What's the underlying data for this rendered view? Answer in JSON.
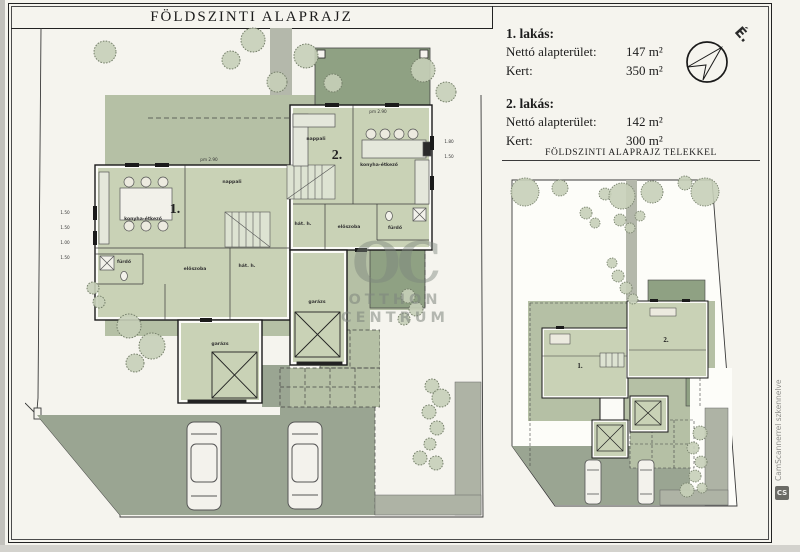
{
  "header": {
    "title": "FÖLDSZINTI ALAPRAJZ"
  },
  "info": {
    "apartments": [
      {
        "name": "1. lakás:",
        "rows": [
          {
            "label": "Nettó alapterület:",
            "value": "147 m²"
          },
          {
            "label": "Kert:",
            "value": "350 m²"
          }
        ]
      },
      {
        "name": "2. lakás:",
        "rows": [
          {
            "label": "Nettó alapterület:",
            "value": "142 m²"
          },
          {
            "label": "Kert:",
            "value": "300 m²"
          }
        ]
      }
    ]
  },
  "compass": {
    "north_label": "É."
  },
  "site_plan": {
    "heading": "FÖLDSZINTI ALAPRAJZ TELEKKEL"
  },
  "main_plan": {
    "unit1": {
      "number": "1.",
      "rooms": {
        "kitchen_dining": "konyha-étkező",
        "living": "nappali",
        "hall": "előszoba",
        "utility": "hát. h.",
        "bath": "fürdő",
        "garage": "garázs"
      }
    },
    "unit2": {
      "number": "2.",
      "rooms": {
        "kitchen_dining": "konyha-étkező",
        "living": "nappali",
        "hall": "előszoba",
        "utility": "hát. h.",
        "bath": "fürdő",
        "garage": "garázs"
      }
    },
    "dimensions": {
      "left": [
        "1.50",
        "1.50",
        "1.00",
        "1.50"
      ],
      "right": [
        "1.80",
        "1.50"
      ],
      "door": "pm 2.90"
    }
  },
  "watermark": {
    "initials": "OC",
    "line1": "OTTHON",
    "line2": "CENTRUM"
  },
  "scanner": {
    "label": "CamScannerrel szkennelve",
    "logo": "CS"
  },
  "colors": {
    "garden": "#b5c0a5",
    "room": "#c9d2b6",
    "terrace": "#8fa183",
    "driveway": "#9aa592",
    "path": "#aeb3a5",
    "paper": "#f5f4ee"
  }
}
